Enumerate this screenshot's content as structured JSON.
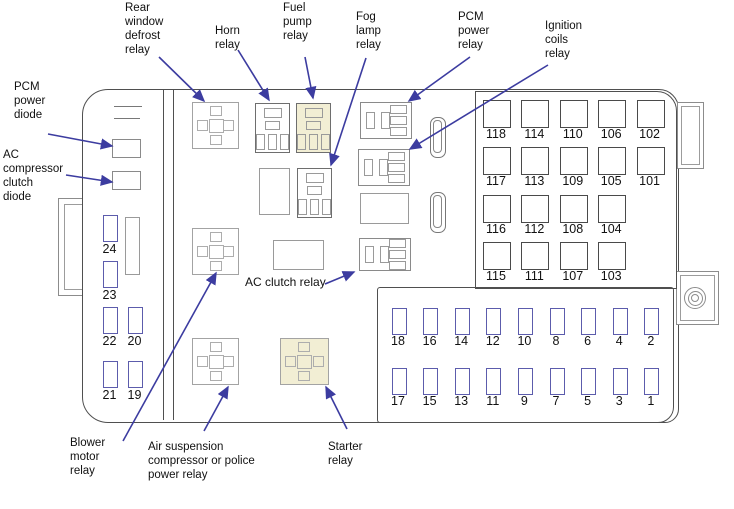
{
  "diagram": {
    "callouts": {
      "pcm_power_diode": "PCM\npower\ndiode",
      "ac_compressor_clutch_diode": "AC\ncompressor\nclutch\ndiode",
      "rear_window_defrost_relay": "Rear\nwindow\ndefrost\nrelay",
      "horn_relay": "Horn\nrelay",
      "fuel_pump_relay": "Fuel\npump\nrelay",
      "fog_lamp_relay": "Fog\nlamp\nrelay",
      "pcm_power_relay": "PCM\npower\nrelay",
      "ignition_coils_relay": "Ignition\ncoils\nrelay",
      "ac_clutch_relay": "AC clutch relay",
      "blower_motor_relay": "Blower\nmotor\nrelay",
      "air_suspension_relay": "Air suspension\ncompressor or police\npower relay",
      "starter_relay": "Starter\nrelay"
    },
    "left_fuses": [
      "24",
      "23",
      "22",
      "20",
      "21",
      "19"
    ],
    "large_fuse_rows": [
      [
        "118",
        "114",
        "110",
        "106",
        "102"
      ],
      [
        "117",
        "113",
        "109",
        "105",
        "101"
      ],
      [
        "116",
        "112",
        "108",
        "104"
      ],
      [
        "115",
        "111",
        "107",
        "103"
      ]
    ],
    "small_fuse_rows": [
      [
        "18",
        "16",
        "14",
        "12",
        "10",
        "8",
        "6",
        "4",
        "2"
      ],
      [
        "17",
        "15",
        "13",
        "11",
        "9",
        "7",
        "5",
        "3",
        "1"
      ]
    ]
  },
  "colors": {
    "arrow": "#3c3ca0",
    "fuse_outline": "#5c5cac",
    "panel_outline": "#4f4f4f",
    "highlight_fill": "#f2eed4",
    "text": "#111111"
  }
}
